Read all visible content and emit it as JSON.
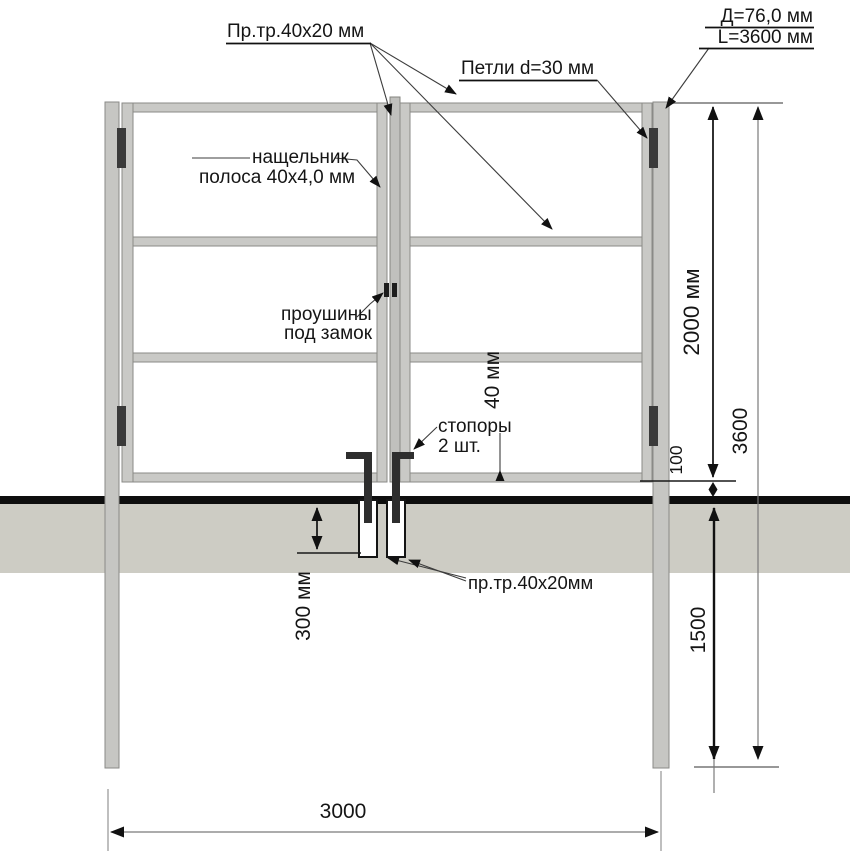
{
  "labels": {
    "profile_tube_top": "Пр.тр.40х20 мм",
    "hinges": "Петли d=30 мм",
    "post_diameter": "Д=76,0 мм",
    "post_length": "L=3600 мм",
    "cover_strip": {
      "line1": "нащельник",
      "line2": "полоса 40х4,0 мм"
    },
    "lock_lugs": {
      "line1": "проушины",
      "line2": "под замок"
    },
    "stoppers": {
      "line1": "стопоры",
      "line2": "2 шт."
    },
    "profile_tube_bottom": "пр.тр.40х20мм"
  },
  "dimensions": {
    "gate_height": "2000 мм",
    "overall_height": "3600",
    "ground_clearance": "100",
    "underground_depth": "1500",
    "sleeve_depth": "300 мм",
    "tube_height": "40 мм",
    "post_span": "3000"
  },
  "colors": {
    "metal": "#c9c9c6",
    "cover_strip": "#c0c0bd",
    "ground": "#cdccc4",
    "ground_line": "#0e0e0e",
    "hardware_dark": "#2e2e2e",
    "line": "#1a1a1a",
    "background": "#ffffff"
  }
}
